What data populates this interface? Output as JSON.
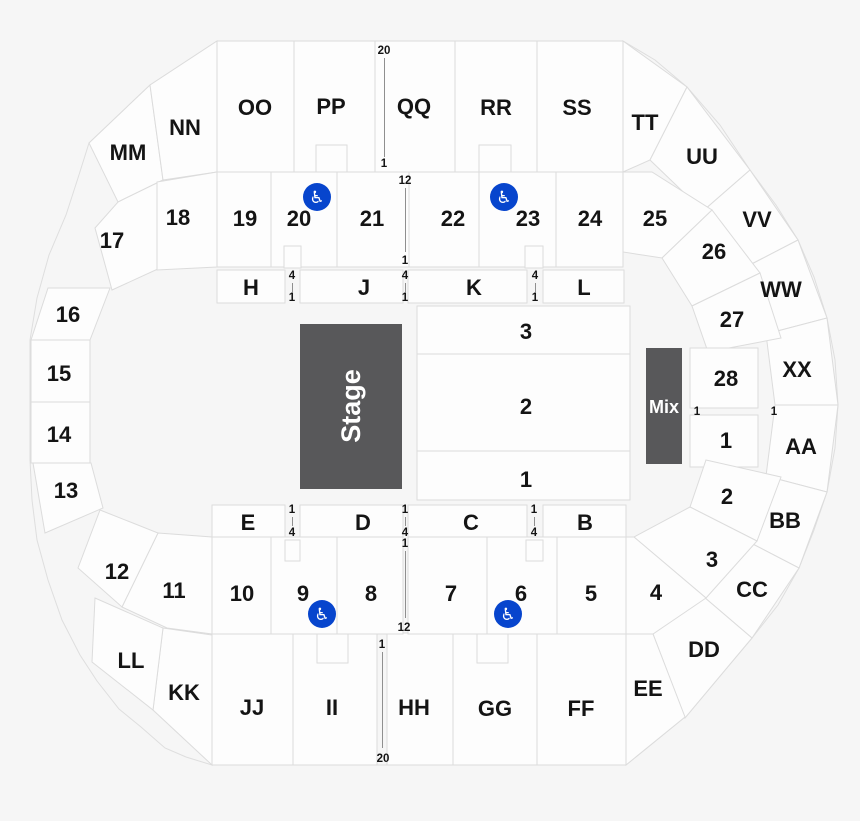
{
  "colors": {
    "background": "#f6f6f6",
    "section_fill": "#fdfdfd",
    "section_border": "#dcdcdc",
    "stage_fill": "#58585a",
    "stage_text": "#ffffff",
    "label_text": "#141414",
    "accessible_blue": "#0745cd",
    "aisle_line": "#8f8f8f"
  },
  "map": {
    "stage_label": "Stage",
    "mix_label": "Mix",
    "floor": {
      "r3": "3",
      "r2": "2",
      "r1": "1"
    },
    "outer": {
      "MM": "MM",
      "NN": "NN",
      "OO": "OO",
      "PP": "PP",
      "QQ": "QQ",
      "RR": "RR",
      "SS": "SS",
      "TT": "TT",
      "UU": "UU",
      "VV": "VV",
      "WW": "WW",
      "XX": "XX",
      "AA": "AA",
      "BB": "BB",
      "CC": "CC",
      "DD": "DD",
      "EE": "EE",
      "FF": "FF",
      "GG": "GG",
      "HH": "HH",
      "II": "II",
      "JJ": "JJ",
      "KK": "KK",
      "LL": "LL"
    },
    "inner": {
      "s1": "1",
      "s2": "2",
      "s3": "3",
      "s4": "4",
      "s5": "5",
      "s6": "6",
      "s7": "7",
      "s8": "8",
      "s9": "9",
      "s10": "10",
      "s11": "11",
      "s12": "12",
      "s13": "13",
      "s14": "14",
      "s15": "15",
      "s16": "16",
      "s17": "17",
      "s18": "18",
      "s19": "19",
      "s20": "20",
      "s21": "21",
      "s22": "22",
      "s23": "23",
      "s24": "24",
      "s25": "25",
      "s26": "26",
      "s27": "27",
      "s28": "28"
    },
    "letters": {
      "H": "H",
      "J": "J",
      "K": "K",
      "L": "L",
      "E": "E",
      "D": "D",
      "C": "C",
      "B": "B"
    },
    "aisles": {
      "qq": {
        "top": "20",
        "bottom": "1"
      },
      "t2122": {
        "top": "12",
        "bottom": "1"
      },
      "hj": {
        "top": "4",
        "bottom": "1"
      },
      "jk": {
        "top": "4",
        "bottom": "1"
      },
      "kl": {
        "top": "4",
        "bottom": "1"
      },
      "ed": {
        "top": "1",
        "bottom": "4"
      },
      "dc": {
        "top": "1",
        "bottom": "4"
      },
      "cb": {
        "top": "1",
        "bottom": "4"
      },
      "b87": {
        "top": "1",
        "bottom": "12"
      },
      "iihh": {
        "top": "1",
        "bottom": "20"
      },
      "row1_left": "1",
      "row1_right": "1"
    },
    "access_symbol": "♿"
  }
}
